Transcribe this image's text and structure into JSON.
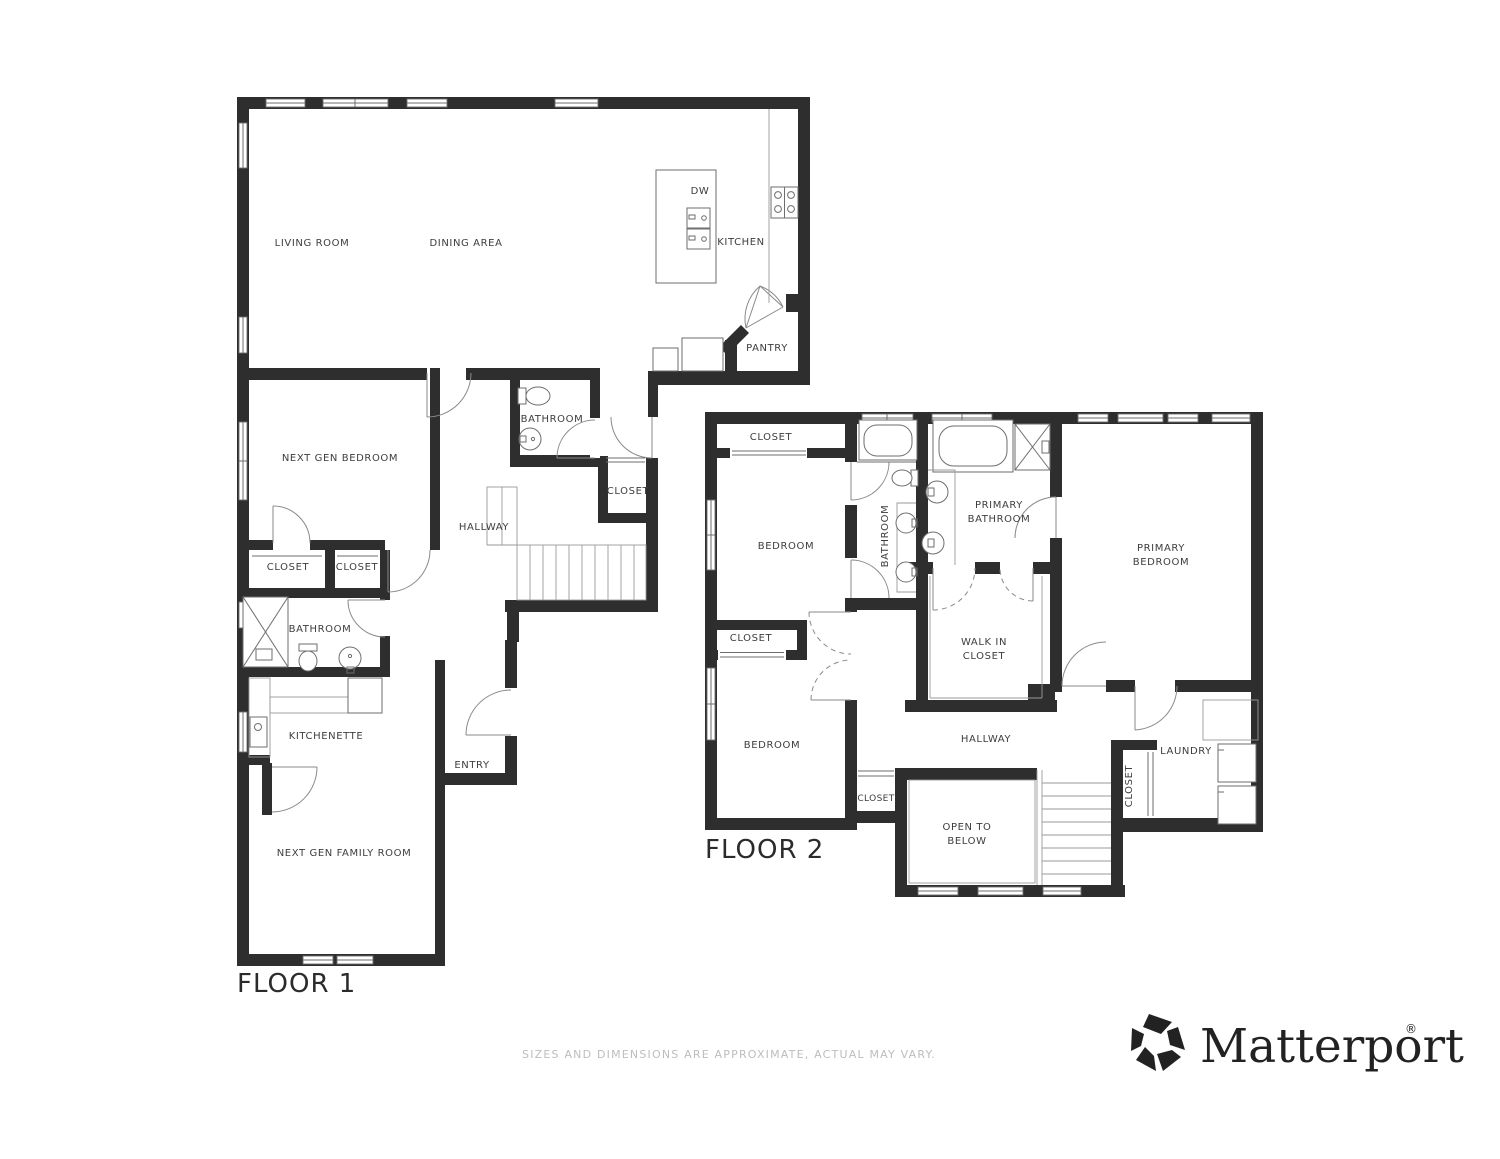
{
  "floor1": {
    "title": "FLOOR 1",
    "rooms": {
      "living_room": "LIVING ROOM",
      "dining_area": "DINING AREA",
      "kitchen": "KITCHEN",
      "dishwasher": "DW",
      "pantry": "PANTRY",
      "bathroom": "BATHROOM",
      "hall_closet": "CLOSET",
      "hallway": "HALLWAY",
      "next_gen_bedroom": "NEXT GEN BEDROOM",
      "closet_a": "CLOSET",
      "closet_b": "CLOSET",
      "bathroom_2": "BATHROOM",
      "kitchenette": "KITCHENETTE",
      "entry": "ENTRY",
      "next_gen_family_room": "NEXT GEN FAMILY ROOM"
    }
  },
  "floor2": {
    "title": "FLOOR 2",
    "rooms": {
      "closet_top": "CLOSET",
      "bedroom_1": "BEDROOM",
      "bathroom": "BATHROOM",
      "primary_bathroom_line1": "PRIMARY",
      "primary_bathroom_line2": "BATHROOM",
      "primary_bedroom_line1": "PRIMARY",
      "primary_bedroom_line2": "BEDROOM",
      "walk_in_closet_line1": "WALK IN",
      "walk_in_closet_line2": "CLOSET",
      "closet_mid": "CLOSET",
      "bedroom_2": "BEDROOM",
      "hallway": "HALLWAY",
      "laundry": "LAUNDRY",
      "closet_stairs": "CLOSET",
      "closet_hall": "CLOSET",
      "open_to_below_line1": "OPEN TO",
      "open_to_below_line2": "BELOW"
    }
  },
  "footer": {
    "disclaimer": "SIZES AND DIMENSIONS ARE APPROXIMATE, ACTUAL MAY VARY.",
    "brand_name": "Matterport",
    "registered_mark": "®"
  },
  "colors": {
    "wall": "#2e2e2e",
    "label": "#3d3d3d",
    "fixture_stroke": "#6e6e6e",
    "disclaimer": "#bdbdbd",
    "brand": "#222222",
    "background": "#ffffff"
  }
}
